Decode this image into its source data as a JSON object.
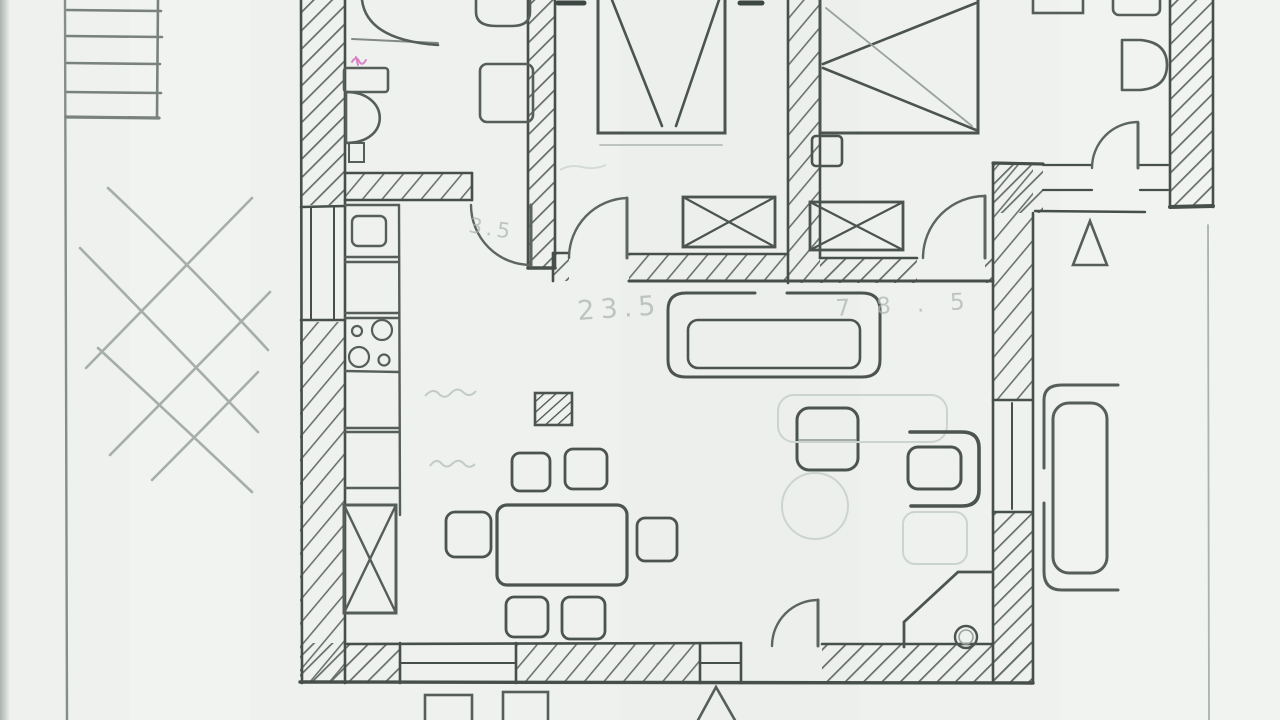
{
  "annotations": {
    "dim_lounge": "23.5",
    "dim_hall": "3.5",
    "dim_right": "78.5"
  },
  "colors": {
    "paper": "#eef1ee",
    "pencil": "#6b736f",
    "pencil_dark": "#3f4744",
    "pencil_faint": "#b6beba",
    "accent_pink": "#d884c4"
  }
}
